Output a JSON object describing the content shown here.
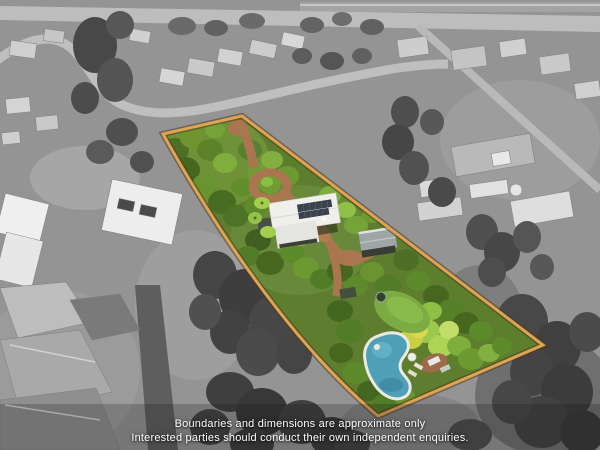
{
  "photo": {
    "kind": "aerial-drone-photo-with-highlighted-property-boundary",
    "highlighted_area": "long narrow tree-covered acreage lot with house, sheds, circular driveway and swimming pool",
    "surroundings": "grayscale suburban neighbourhood"
  },
  "disclaimer": {
    "line1": "Boundaries and dimensions are approximate only",
    "line2": "Interested parties should conduct their own independent enquiries."
  },
  "colors": {
    "boundary": "#e0a253",
    "boundary_outline": "#4a3a1e",
    "pool_water": "#4f9fb7",
    "driveway_dirt": "#a9764f",
    "canopy_green": "#5f7d2f",
    "grayscale_base": "#949494",
    "text": "#ffffff"
  },
  "features": {
    "boundary": "property-boundary",
    "house": "house-with-solar-panels",
    "shed": "garden-shed",
    "driveway": "dirt-driveway-with-circular-loop",
    "pool": "swimming-pool",
    "lawn": "back-lawn"
  }
}
